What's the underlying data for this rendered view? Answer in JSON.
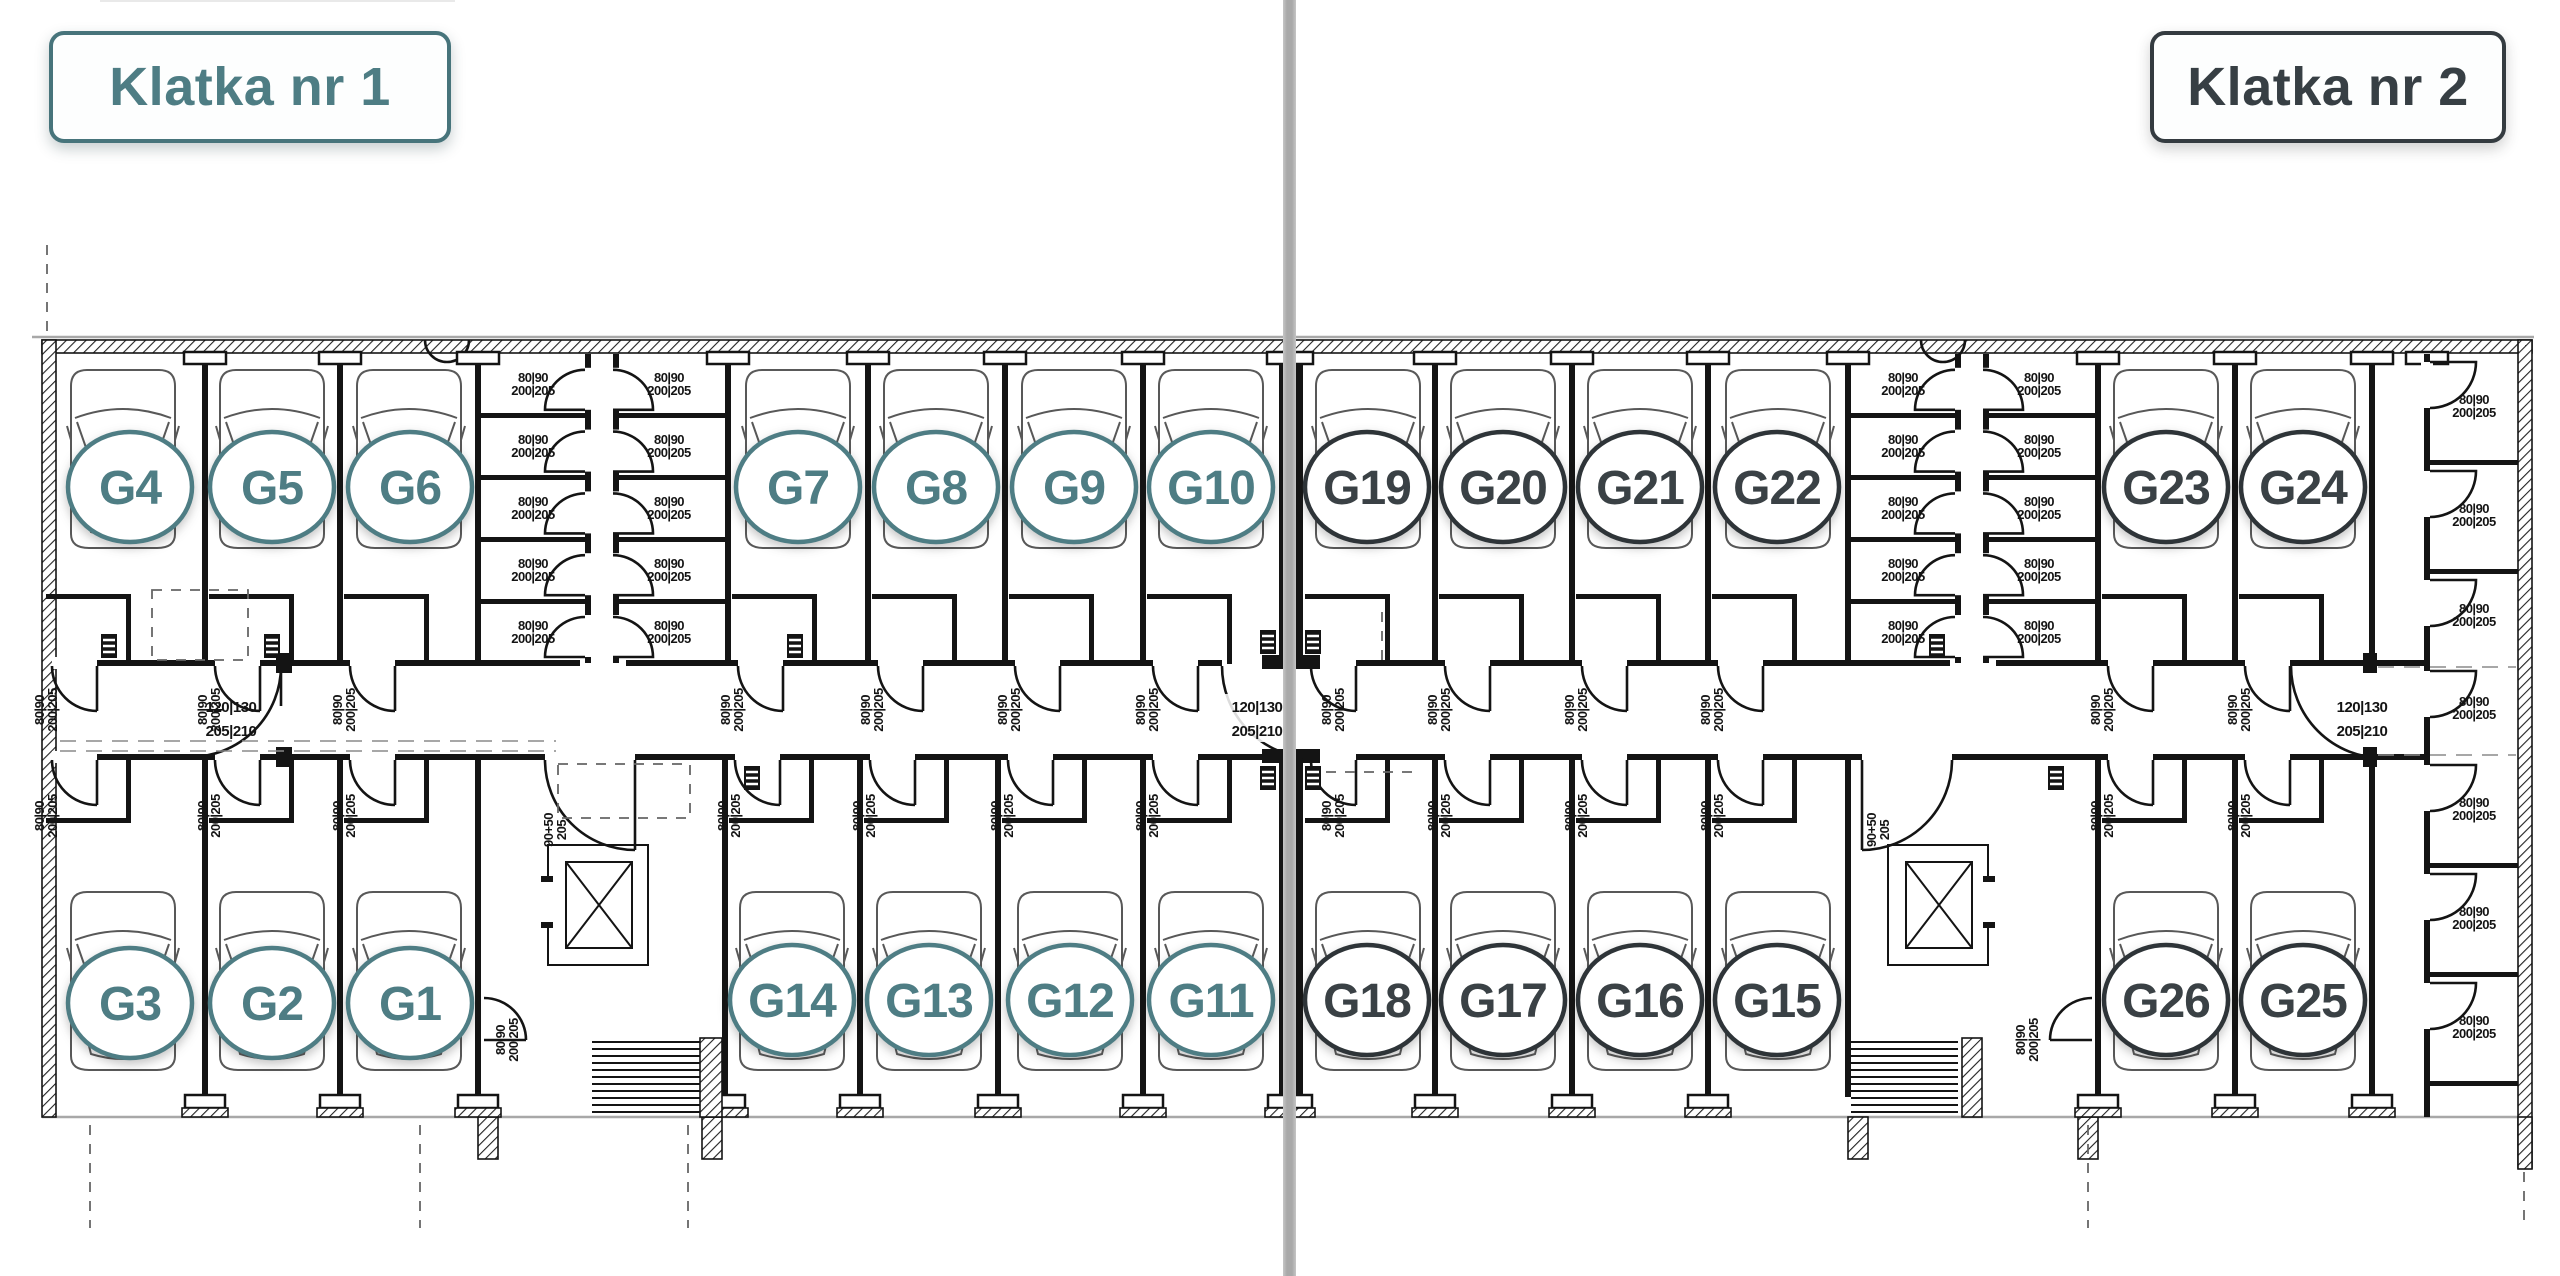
{
  "header": {
    "klatka1": "Klatka nr 1",
    "klatka2": "Klatka nr 2"
  },
  "sections": [
    {
      "name": "Klatka nr 1",
      "accent": "#4e7d84",
      "side": "left"
    },
    {
      "name": "Klatka nr 2",
      "accent": "#3a4145",
      "side": "right"
    }
  ],
  "garages": [
    {
      "label": "G1",
      "klatka": 1,
      "color": "#4e7d84"
    },
    {
      "label": "G2",
      "klatka": 1,
      "color": "#4e7d84"
    },
    {
      "label": "G3",
      "klatka": 1,
      "color": "#4e7d84"
    },
    {
      "label": "G4",
      "klatka": 1,
      "color": "#4e7d84"
    },
    {
      "label": "G5",
      "klatka": 1,
      "color": "#4e7d84"
    },
    {
      "label": "G6",
      "klatka": 1,
      "color": "#4e7d84"
    },
    {
      "label": "G7",
      "klatka": 1,
      "color": "#4e7d84"
    },
    {
      "label": "G8",
      "klatka": 1,
      "color": "#4e7d84"
    },
    {
      "label": "G9",
      "klatka": 1,
      "color": "#4e7d84"
    },
    {
      "label": "G10",
      "klatka": 1,
      "color": "#4e7d84"
    },
    {
      "label": "G11",
      "klatka": 1,
      "color": "#4e7d84"
    },
    {
      "label": "G12",
      "klatka": 1,
      "color": "#4e7d84"
    },
    {
      "label": "G13",
      "klatka": 1,
      "color": "#4e7d84"
    },
    {
      "label": "G14",
      "klatka": 1,
      "color": "#4e7d84"
    },
    {
      "label": "G15",
      "klatka": 2,
      "color": "#3a4145"
    },
    {
      "label": "G16",
      "klatka": 2,
      "color": "#3a4145"
    },
    {
      "label": "G17",
      "klatka": 2,
      "color": "#3a4145"
    },
    {
      "label": "G18",
      "klatka": 2,
      "color": "#3a4145"
    },
    {
      "label": "G19",
      "klatka": 2,
      "color": "#3a4145"
    },
    {
      "label": "G20",
      "klatka": 2,
      "color": "#3a4145"
    },
    {
      "label": "G21",
      "klatka": 2,
      "color": "#3a4145"
    },
    {
      "label": "G22",
      "klatka": 2,
      "color": "#3a4145"
    },
    {
      "label": "G23",
      "klatka": 2,
      "color": "#3a4145"
    },
    {
      "label": "G24",
      "klatka": 2,
      "color": "#3a4145"
    },
    {
      "label": "G25",
      "klatka": 2,
      "color": "#3a4145"
    },
    {
      "label": "G26",
      "klatka": 2,
      "color": "#3a4145"
    }
  ],
  "door_labels": {
    "small_w": "80|90",
    "small_h": "200|205",
    "corridor_w": "120|130",
    "corridor_h": "205|210",
    "stair_w": "90+50",
    "stair_h": "205"
  },
  "colors": {
    "accent_teal": "#4e7d84",
    "accent_dark": "#3a4145",
    "divider_gray": "#aaaaaa",
    "plan_line": "#141414",
    "plan_light_line": "#a8a8a8",
    "background": "#ffffff"
  }
}
